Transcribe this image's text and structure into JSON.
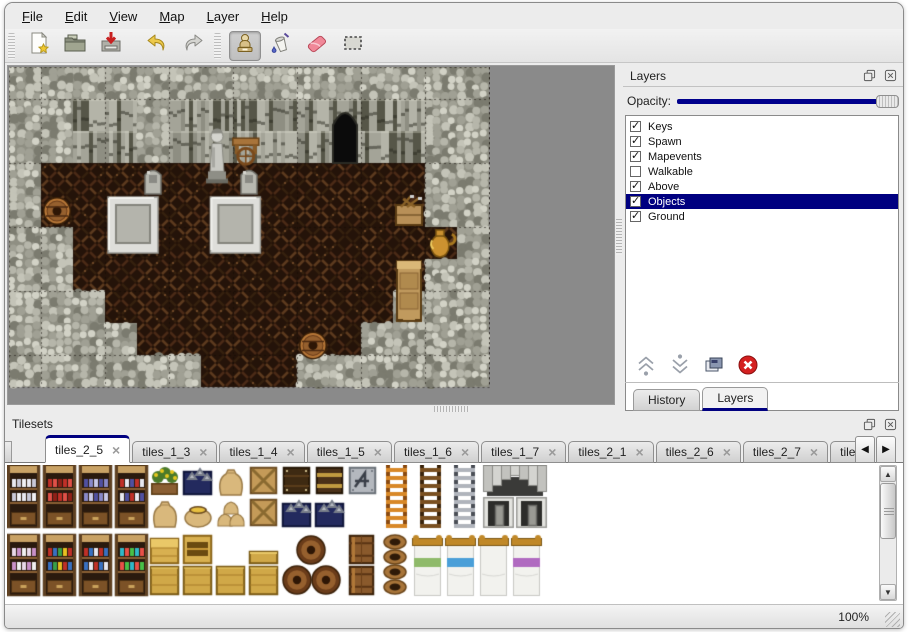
{
  "icons": {
    "scroll_left": "◀",
    "scroll_right": "▶",
    "arrow_up": "▲",
    "arrow_down": "▼",
    "close_x": "×",
    "check": "✓"
  },
  "colors": {
    "accent": "#000080",
    "selection_bg": "#000080",
    "opacity_fill": "#00008c",
    "window_bg": "#ececec"
  },
  "menu": {
    "items": [
      {
        "label": "File"
      },
      {
        "label": "Edit"
      },
      {
        "label": "View"
      },
      {
        "label": "Map"
      },
      {
        "label": "Layer"
      },
      {
        "label": "Help"
      }
    ]
  },
  "toolbar": {
    "buttons": [
      {
        "name": "new-file-button",
        "icon": "new-file-icon",
        "active": false,
        "group": 0
      },
      {
        "name": "open-button",
        "icon": "open-folder-icon",
        "active": false,
        "group": 0
      },
      {
        "name": "save-button",
        "icon": "save-icon",
        "active": false,
        "group": 0
      },
      {
        "name": "undo-button",
        "icon": "undo-arrow-icon",
        "active": false,
        "group": 1
      },
      {
        "name": "redo-button",
        "icon": "redo-arrow-icon",
        "active": false,
        "group": 1
      },
      {
        "name": "stamp-tool-button",
        "icon": "stamp-icon",
        "active": true,
        "group": 2
      },
      {
        "name": "fill-tool-button",
        "icon": "paint-bucket-icon",
        "active": false,
        "group": 2
      },
      {
        "name": "eraser-tool-button",
        "icon": "eraser-icon",
        "active": false,
        "group": 2
      },
      {
        "name": "select-tool-button",
        "icon": "selection-icon",
        "active": false,
        "group": 2
      }
    ]
  },
  "map_view": {
    "tile_size": 32,
    "legend": {
      "W": "wall-top",
      "F": "wall-face",
      "G": "floor",
      "C": "cave"
    },
    "grid": [
      "WWWWWWWWWWWWWWW",
      "WWFFWFFFFFCFFWW",
      "WWFFWFFFFFCFFWW",
      "WGGGGGGGGGGGGWW",
      "WGGGGGGGGGGGGWW",
      "WWGGGGGGGGGGGGW",
      "WWGGGGGGGGGGGWW",
      "WWWGGGGGGGGGWWW",
      "WWWWGGGGGGGWWWW",
      "WWWWWWGGGWWWWWW"
    ],
    "objects": [
      {
        "kind": "cave",
        "c": 10,
        "r": 1,
        "w": 1,
        "h": 2
      },
      {
        "kind": "statue",
        "c": 6,
        "r": 1.7,
        "w": 1,
        "h": 2
      },
      {
        "kind": "cart",
        "c": 6.9,
        "r": 2.1,
        "w": 1,
        "h": 1
      },
      {
        "kind": "gravestone",
        "c": 4,
        "r": 3,
        "w": 1,
        "h": 1
      },
      {
        "kind": "gravestone",
        "c": 7,
        "r": 3,
        "w": 1,
        "h": 1
      },
      {
        "kind": "tomb",
        "c": 3,
        "r": 4,
        "w": 1.75,
        "h": 2
      },
      {
        "kind": "tomb",
        "c": 6.2,
        "r": 4,
        "w": 1.75,
        "h": 2
      },
      {
        "kind": "barrel",
        "c": 1,
        "r": 4,
        "w": 1,
        "h": 1
      },
      {
        "kind": "toolcrate",
        "c": 12,
        "r": 4,
        "w": 1,
        "h": 1
      },
      {
        "kind": "amphora",
        "c": 13,
        "r": 5,
        "w": 1,
        "h": 1
      },
      {
        "kind": "cabinet",
        "c": 12,
        "r": 6,
        "w": 1,
        "h": 2
      },
      {
        "kind": "barrel",
        "c": 9,
        "r": 8.2,
        "w": 1,
        "h": 1
      }
    ],
    "palette": {
      "wall_top_base": "#8f8f83",
      "wall_top_shades": [
        "#d2d2c6",
        "#b6b6aa",
        "#a0a094",
        "#c4c4b8",
        "#7b7b6f"
      ],
      "wall_face_base": "#6e6e62",
      "wall_face_shades": [
        "#8e8e82",
        "#a4a498",
        "#565648",
        "#b4b4a8"
      ],
      "floor_base": "#241309",
      "floor_weave": [
        "#4a2a16",
        "#5c3a1e",
        "#35200e",
        "#6b4526"
      ],
      "grid_line": "rgba(15,10,5,0.5)",
      "cave": "#0b0b0b"
    }
  },
  "layers_panel": {
    "title": "Layers",
    "opacity_label": "Opacity:",
    "opacity_percent": 100,
    "layers": [
      {
        "name": "Keys",
        "visible": true,
        "selected": false
      },
      {
        "name": "Spawn",
        "visible": true,
        "selected": false
      },
      {
        "name": "Mapevents",
        "visible": true,
        "selected": false
      },
      {
        "name": "Walkable",
        "visible": false,
        "selected": false
      },
      {
        "name": "Above",
        "visible": true,
        "selected": false
      },
      {
        "name": "Objects",
        "visible": true,
        "selected": true
      },
      {
        "name": "Ground",
        "visible": true,
        "selected": false
      }
    ],
    "action_buttons": [
      {
        "name": "move-layer-up-button",
        "icon": "chevron-double-up-icon"
      },
      {
        "name": "move-layer-down-button",
        "icon": "chevron-double-down-icon"
      },
      {
        "name": "duplicate-layer-button",
        "icon": "duplicate-icon"
      },
      {
        "name": "delete-layer-button",
        "icon": "delete-icon"
      }
    ]
  },
  "dock_tabs": [
    {
      "label": "History",
      "active": false
    },
    {
      "label": "Layers",
      "active": true
    }
  ],
  "tilesets_panel": {
    "title": "Tilesets",
    "tabs": [
      {
        "label": "tiles_2_5",
        "active": true
      },
      {
        "label": "tiles_1_3",
        "active": false
      },
      {
        "label": "tiles_1_4",
        "active": false
      },
      {
        "label": "tiles_1_5",
        "active": false
      },
      {
        "label": "tiles_1_6",
        "active": false
      },
      {
        "label": "tiles_1_7",
        "active": false
      },
      {
        "label": "tiles_2_1",
        "active": false
      },
      {
        "label": "tiles_2_6",
        "active": false
      },
      {
        "label": "tiles_2_7",
        "active": false
      },
      {
        "label": "tiles_",
        "active": false,
        "truncated": true
      }
    ],
    "shelf_palettes": {
      "dishes": [
        "#e8e8f0",
        "#c8c8d8",
        "#f0f0f4"
      ],
      "red": [
        "#c03028",
        "#e05048",
        "#902018"
      ],
      "blue": [
        "#5050a0",
        "#8888c8",
        "#c8c8e8"
      ],
      "mixed": [
        "#c03028",
        "#e8e8f0",
        "#5050a0"
      ],
      "jars": [
        "#e8d8e8",
        "#c890c8",
        "#f0f0f0"
      ],
      "books": [
        "#c03028",
        "#3870c0",
        "#38a048",
        "#e8c020"
      ],
      "bottles": [
        "#c03028",
        "#3870c0",
        "#e8e8f0"
      ],
      "cyan": [
        "#30b8c8",
        "#e85048",
        "#48c048"
      ]
    },
    "tiles": [
      {
        "x": 0,
        "y": 0,
        "w": 33,
        "h": 63,
        "kind": "shelf",
        "variant": "dishes"
      },
      {
        "x": 36,
        "y": 0,
        "w": 33,
        "h": 63,
        "kind": "shelf",
        "variant": "red"
      },
      {
        "x": 72,
        "y": 0,
        "w": 33,
        "h": 63,
        "kind": "shelf",
        "variant": "blue"
      },
      {
        "x": 108,
        "y": 0,
        "w": 33,
        "h": 63,
        "kind": "shelf",
        "variant": "mixed"
      },
      {
        "x": 142,
        "y": 0,
        "w": 31,
        "h": 31,
        "kind": "flowerbox"
      },
      {
        "x": 175,
        "y": 0,
        "w": 31,
        "h": 31,
        "kind": "silverbox"
      },
      {
        "x": 208,
        "y": 0,
        "w": 31,
        "h": 31,
        "kind": "sack"
      },
      {
        "x": 241,
        "y": 0,
        "w": 31,
        "h": 31,
        "kind": "crate"
      },
      {
        "x": 274,
        "y": 0,
        "w": 31,
        "h": 31,
        "kind": "darkcrate"
      },
      {
        "x": 307,
        "y": 0,
        "w": 31,
        "h": 31,
        "kind": "bandcrate"
      },
      {
        "x": 340,
        "y": 0,
        "w": 31,
        "h": 31,
        "kind": "steelcrate"
      },
      {
        "x": 142,
        "y": 32,
        "w": 31,
        "h": 31,
        "kind": "sack"
      },
      {
        "x": 175,
        "y": 32,
        "w": 31,
        "h": 31,
        "kind": "opensack"
      },
      {
        "x": 208,
        "y": 32,
        "w": 31,
        "h": 31,
        "kind": "sackstack"
      },
      {
        "x": 241,
        "y": 32,
        "w": 31,
        "h": 31,
        "kind": "crate"
      },
      {
        "x": 274,
        "y": 32,
        "w": 31,
        "h": 31,
        "kind": "silverbox"
      },
      {
        "x": 307,
        "y": 32,
        "w": 31,
        "h": 31,
        "kind": "silverbox"
      },
      {
        "x": 374,
        "y": 0,
        "w": 31,
        "h": 63,
        "kind": "ladder",
        "variant": "orange"
      },
      {
        "x": 408,
        "y": 0,
        "w": 31,
        "h": 63,
        "kind": "ladder",
        "variant": "brown"
      },
      {
        "x": 442,
        "y": 0,
        "w": 31,
        "h": 63,
        "kind": "ladder",
        "variant": "steel"
      },
      {
        "x": 476,
        "y": 0,
        "w": 64,
        "h": 31,
        "kind": "archtop"
      },
      {
        "x": 476,
        "y": 32,
        "w": 31,
        "h": 31,
        "kind": "stonedoor"
      },
      {
        "x": 509,
        "y": 32,
        "w": 31,
        "h": 31,
        "kind": "stonedoor"
      },
      {
        "x": 0,
        "y": 69,
        "w": 33,
        "h": 62,
        "kind": "shelf",
        "variant": "jars"
      },
      {
        "x": 36,
        "y": 69,
        "w": 33,
        "h": 62,
        "kind": "shelf",
        "variant": "books"
      },
      {
        "x": 72,
        "y": 69,
        "w": 33,
        "h": 62,
        "kind": "shelf",
        "variant": "bottles"
      },
      {
        "x": 108,
        "y": 69,
        "w": 33,
        "h": 62,
        "kind": "shelf",
        "variant": "cyan"
      },
      {
        "x": 142,
        "y": 69,
        "w": 31,
        "h": 31,
        "kind": "ychest"
      },
      {
        "x": 175,
        "y": 69,
        "w": 31,
        "h": 31,
        "kind": "ycab"
      },
      {
        "x": 241,
        "y": 85,
        "w": 31,
        "h": 15,
        "kind": "ycratehalf"
      },
      {
        "x": 142,
        "y": 100,
        "w": 31,
        "h": 31,
        "kind": "ycrate"
      },
      {
        "x": 175,
        "y": 100,
        "w": 31,
        "h": 31,
        "kind": "ycrate"
      },
      {
        "x": 208,
        "y": 100,
        "w": 31,
        "h": 31,
        "kind": "ycrate"
      },
      {
        "x": 241,
        "y": 100,
        "w": 31,
        "h": 31,
        "kind": "ycrate"
      },
      {
        "x": 274,
        "y": 69,
        "w": 62,
        "h": 62,
        "kind": "barrelpile"
      },
      {
        "x": 339,
        "y": 69,
        "w": 31,
        "h": 31,
        "kind": "barrelfront"
      },
      {
        "x": 339,
        "y": 100,
        "w": 31,
        "h": 31,
        "kind": "barrelfront"
      },
      {
        "x": 372,
        "y": 69,
        "w": 31,
        "h": 62,
        "kind": "pots"
      },
      {
        "x": 405,
        "y": 69,
        "w": 31,
        "h": 62,
        "kind": "bed",
        "variant": "green"
      },
      {
        "x": 438,
        "y": 69,
        "w": 31,
        "h": 62,
        "kind": "bed",
        "variant": "blue"
      },
      {
        "x": 471,
        "y": 69,
        "w": 31,
        "h": 62,
        "kind": "bed",
        "variant": "plain"
      },
      {
        "x": 504,
        "y": 69,
        "w": 31,
        "h": 62,
        "kind": "bed",
        "variant": "purple"
      }
    ],
    "bed_colors": {
      "green": "#8fba6a",
      "blue": "#4a9fd8",
      "plain": "",
      "purple": "#b06ac0"
    }
  },
  "status_bar": {
    "zoom": "100%"
  }
}
